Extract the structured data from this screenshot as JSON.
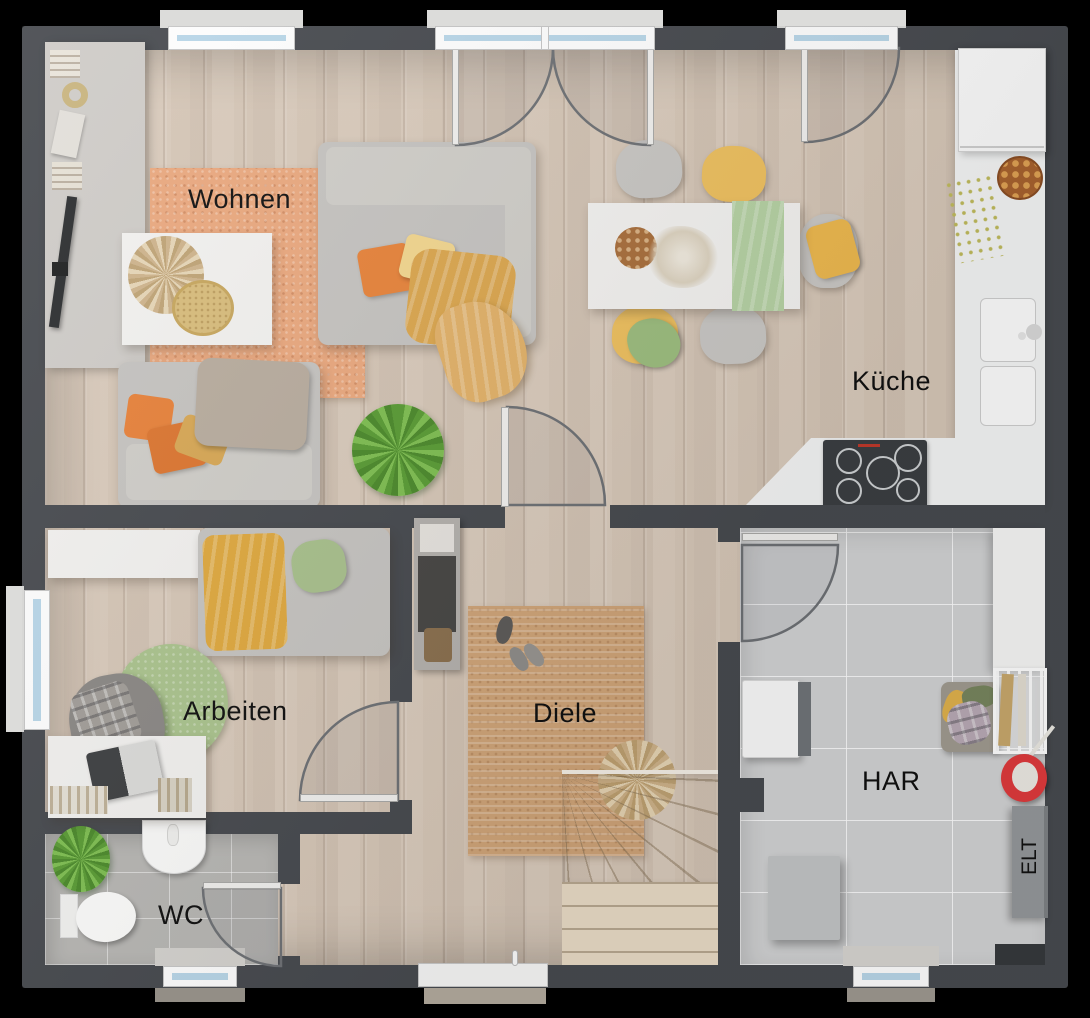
{
  "rooms": {
    "wohnen": {
      "label": "Wohnen"
    },
    "kueche": {
      "label": "Küche"
    },
    "arbeiten": {
      "label": "Arbeiten"
    },
    "diele": {
      "label": "Diele"
    },
    "wc": {
      "label": "WC"
    },
    "har": {
      "label": "HAR"
    },
    "elt": {
      "label": "ELT"
    }
  },
  "colors": {
    "background": "#000000",
    "exterior_wall": "#474a4f",
    "wood_floor": "#d6c8ba",
    "tile_wc": "#b8b7b4",
    "tile_har": "#d2d3d4",
    "rug_living_orange": "#eba97f",
    "rug_hall_jute": "#cfa478",
    "rug_office_green": "#abc48e",
    "kitchen_counter": "#f4f5f5",
    "cooktop": "#3b3e42",
    "window_glass": "#b9d7e9",
    "accent_orange_pillow": "#e8843b",
    "accent_yellow_chair": "#eec05f",
    "accent_green_runner": "#b6d2a4",
    "mop_bucket_red": "#df3a3c",
    "label_text": "#101010"
  }
}
